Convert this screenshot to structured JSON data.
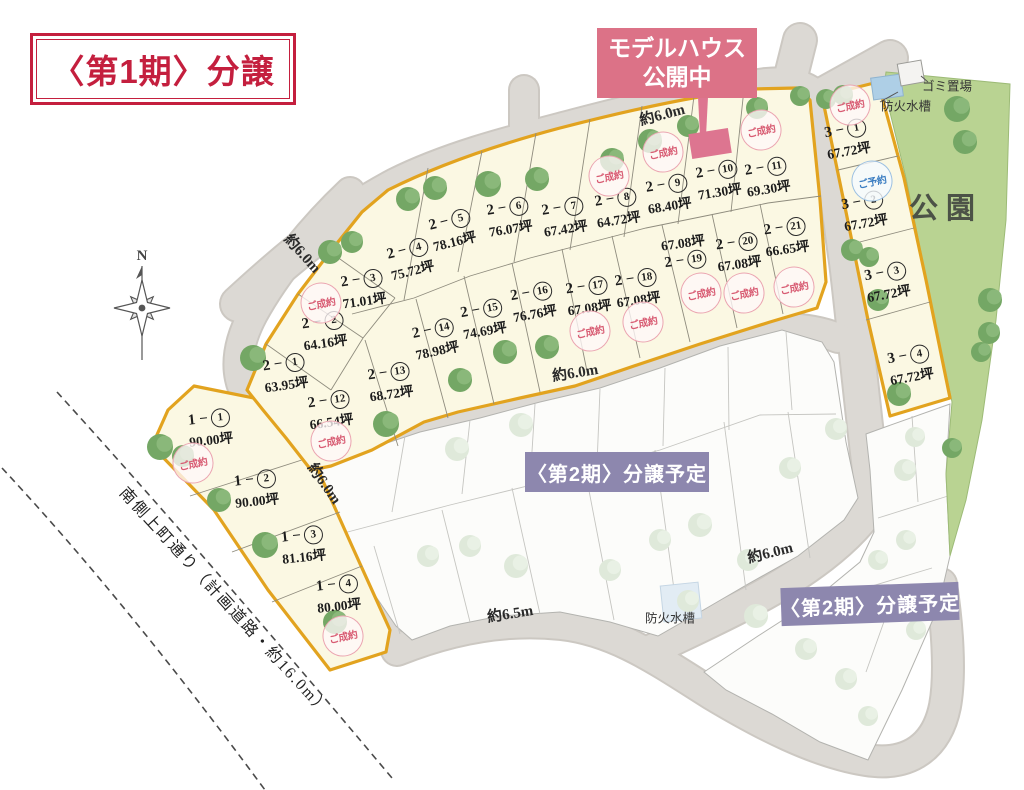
{
  "title": "〈第1期〉分譲",
  "model_house_banner": {
    "line1": "モデルハウス",
    "line2": "公開中",
    "lot": "2-10"
  },
  "phase2_label": "〈第2期〉分譲予定",
  "park_label": "公園",
  "compass_label": "N",
  "landmarks": {
    "garbage": "ゴミ置場",
    "fire_tank_top": "防火水槽",
    "fire_tank_bottom": "防火水槽",
    "planned_road": "南側上町通り（計画道路・約16.0m）"
  },
  "status_labels": {
    "sold": "ご成約",
    "reserved": "ご予約"
  },
  "colors": {
    "title_red": "#c41f3e",
    "banner_pink": "#dc7287",
    "marker_pink": "#dd7590",
    "phase2_purple": "#8d87ae",
    "block_outline_gold": "#e2a31f",
    "block_fill": "#fbf8e3",
    "road_gray": "#dcd9d4",
    "park_green": "#b9d392",
    "sold_pink": "#d85c73",
    "reserved_blue": "#3c7ec2"
  },
  "road_labels": [
    {
      "text": "約6.0m",
      "x": 662,
      "y": 114,
      "rot": -15
    },
    {
      "text": "約6.0m",
      "x": 303,
      "y": 253,
      "rot": 48
    },
    {
      "text": "約6.0m",
      "x": 325,
      "y": 483,
      "rot": 55
    },
    {
      "text": "約6.0m",
      "x": 575,
      "y": 372,
      "rot": -9
    },
    {
      "text": "約6.5m",
      "x": 510,
      "y": 613,
      "rot": -9
    },
    {
      "text": "約6.0m",
      "x": 770,
      "y": 552,
      "rot": -14
    }
  ],
  "lots": [
    {
      "id": "1-1",
      "block": "1",
      "num": "1",
      "area": "90.00坪",
      "x": 210,
      "y": 429,
      "rot": -6,
      "status": "sold",
      "sx": 193,
      "sy": 463
    },
    {
      "id": "1-2",
      "block": "1",
      "num": "2",
      "area": "90.00坪",
      "x": 256,
      "y": 490,
      "rot": -6
    },
    {
      "id": "1-3",
      "block": "1",
      "num": "3",
      "area": "81.16坪",
      "x": 303,
      "y": 546,
      "rot": -6
    },
    {
      "id": "1-4",
      "block": "1",
      "num": "4",
      "area": "80.00坪",
      "x": 338,
      "y": 595,
      "rot": -6,
      "status": "sold",
      "sx": 343,
      "sy": 636
    },
    {
      "id": "2-1",
      "block": "2",
      "num": "1",
      "area": "63.95坪",
      "x": 285,
      "y": 374,
      "rot": -8
    },
    {
      "id": "2-2",
      "block": "2",
      "num": "2",
      "area": "64.16坪",
      "x": 324,
      "y": 332,
      "rot": -8,
      "status": "sold",
      "sx": 321,
      "sy": 303
    },
    {
      "id": "2-3",
      "block": "2",
      "num": "3",
      "area": "71.01坪",
      "x": 363,
      "y": 290,
      "rot": -8
    },
    {
      "id": "2-4",
      "block": "2",
      "num": "4",
      "area": "75.72坪",
      "x": 410,
      "y": 260,
      "rot": -14
    },
    {
      "id": "2-5",
      "block": "2",
      "num": "5",
      "area": "78.16坪",
      "x": 452,
      "y": 231,
      "rot": -14
    },
    {
      "id": "2-6",
      "block": "2",
      "num": "6",
      "area": "76.07坪",
      "x": 509,
      "y": 218,
      "rot": -9
    },
    {
      "id": "2-7",
      "block": "2",
      "num": "7",
      "area": "67.42坪",
      "x": 564,
      "y": 218,
      "rot": -9
    },
    {
      "id": "2-8",
      "block": "2",
      "num": "8",
      "area": "64.72坪",
      "x": 617,
      "y": 209,
      "rot": -9,
      "status": "sold",
      "sx": 609,
      "sy": 176
    },
    {
      "id": "2-9",
      "block": "2",
      "num": "9",
      "area": "68.40坪",
      "x": 668,
      "y": 195,
      "rot": -9,
      "status": "sold",
      "sx": 663,
      "sy": 152
    },
    {
      "id": "2-10",
      "block": "2",
      "num": "10",
      "area": "71.30坪",
      "x": 718,
      "y": 181,
      "rot": -9,
      "model_house": true
    },
    {
      "id": "2-11",
      "block": "2",
      "num": "11",
      "area": "69.30坪",
      "x": 767,
      "y": 178,
      "rot": -9,
      "status": "sold",
      "sx": 761,
      "sy": 130
    },
    {
      "id": "2-12",
      "block": "2",
      "num": "12",
      "area": "66.54坪",
      "x": 330,
      "y": 411,
      "rot": -8,
      "status": "sold",
      "sx": 331,
      "sy": 441
    },
    {
      "id": "2-13",
      "block": "2",
      "num": "13",
      "area": "68.72坪",
      "x": 390,
      "y": 383,
      "rot": -8
    },
    {
      "id": "2-14",
      "block": "2",
      "num": "14",
      "area": "78.98坪",
      "x": 435,
      "y": 340,
      "rot": -12
    },
    {
      "id": "2-15",
      "block": "2",
      "num": "15",
      "area": "74.69坪",
      "x": 483,
      "y": 320,
      "rot": -10
    },
    {
      "id": "2-16",
      "block": "2",
      "num": "16",
      "area": "76.76坪",
      "x": 533,
      "y": 303,
      "rot": -10
    },
    {
      "id": "2-17",
      "block": "2",
      "num": "17",
      "area": "67.08坪",
      "x": 588,
      "y": 297,
      "rot": -8,
      "status": "sold",
      "sx": 590,
      "sy": 331
    },
    {
      "id": "2-18",
      "block": "2",
      "num": "18",
      "area": "67.08坪",
      "x": 637,
      "y": 289,
      "rot": -8,
      "status": "sold",
      "sx": 643,
      "sy": 322
    },
    {
      "id": "2-19",
      "block": "2",
      "num": "19",
      "area": "67.08坪",
      "x": 684,
      "y": 251,
      "rot": -8,
      "rev": true,
      "status": "sold",
      "sx": 701,
      "sy": 293
    },
    {
      "id": "2-20",
      "block": "2",
      "num": "20",
      "area": "67.08坪",
      "x": 738,
      "y": 253,
      "rot": -8,
      "status": "sold",
      "sx": 744,
      "sy": 293
    },
    {
      "id": "2-21",
      "block": "2",
      "num": "21",
      "area": "66.65坪",
      "x": 786,
      "y": 238,
      "rot": -8,
      "status": "sold",
      "sx": 794,
      "sy": 287
    },
    {
      "id": "3-1",
      "block": "3",
      "num": "1",
      "area": "67.72坪",
      "x": 847,
      "y": 140,
      "rot": -10,
      "status": "sold",
      "sx": 850,
      "sy": 105
    },
    {
      "id": "3-2",
      "block": "3",
      "num": "2",
      "area": "67.72坪",
      "x": 864,
      "y": 212,
      "rot": -10,
      "status": "reserved",
      "sx": 872,
      "sy": 181
    },
    {
      "id": "3-3",
      "block": "3",
      "num": "3",
      "area": "67.72坪",
      "x": 887,
      "y": 283,
      "rot": -10
    },
    {
      "id": "3-4",
      "block": "3",
      "num": "4",
      "area": "67.72坪",
      "x": 910,
      "y": 366,
      "rot": -10
    }
  ],
  "trees_dark": [
    [
      160,
      447,
      13
    ],
    [
      183,
      456,
      11
    ],
    [
      219,
      500,
      12
    ],
    [
      265,
      545,
      13
    ],
    [
      335,
      622,
      12
    ],
    [
      253,
      358,
      13
    ],
    [
      386,
      424,
      13
    ],
    [
      330,
      252,
      12
    ],
    [
      352,
      242,
      11
    ],
    [
      408,
      199,
      12
    ],
    [
      435,
      188,
      12
    ],
    [
      488,
      184,
      13
    ],
    [
      537,
      179,
      12
    ],
    [
      612,
      160,
      12
    ],
    [
      650,
      141,
      12
    ],
    [
      688,
      126,
      11
    ],
    [
      757,
      108,
      11
    ],
    [
      800,
      96,
      10
    ],
    [
      826,
      99,
      10
    ],
    [
      843,
      95,
      10
    ],
    [
      460,
      380,
      12
    ],
    [
      505,
      352,
      12
    ],
    [
      547,
      347,
      12
    ],
    [
      852,
      250,
      11
    ],
    [
      869,
      257,
      10
    ],
    [
      878,
      300,
      11
    ],
    [
      899,
      394,
      12
    ],
    [
      957,
      109,
      13
    ],
    [
      965,
      142,
      12
    ],
    [
      990,
      300,
      12
    ],
    [
      989,
      333,
      11
    ],
    [
      981,
      352,
      10
    ],
    [
      952,
      448,
      10
    ]
  ],
  "trees_pale": [
    [
      457,
      449,
      12
    ],
    [
      521,
      425,
      12
    ],
    [
      628,
      474,
      11
    ],
    [
      700,
      525,
      12
    ],
    [
      790,
      468,
      11
    ],
    [
      836,
      429,
      11
    ],
    [
      428,
      556,
      11
    ],
    [
      470,
      546,
      11
    ],
    [
      516,
      566,
      12
    ],
    [
      610,
      570,
      11
    ],
    [
      660,
      540,
      11
    ],
    [
      748,
      560,
      11
    ],
    [
      688,
      601,
      11
    ],
    [
      756,
      616,
      12
    ],
    [
      806,
      649,
      11
    ],
    [
      846,
      679,
      11
    ],
    [
      868,
      716,
      10
    ],
    [
      905,
      470,
      11
    ],
    [
      915,
      437,
      10
    ],
    [
      878,
      560,
      10
    ],
    [
      906,
      540,
      10
    ],
    [
      916,
      630,
      10
    ]
  ]
}
